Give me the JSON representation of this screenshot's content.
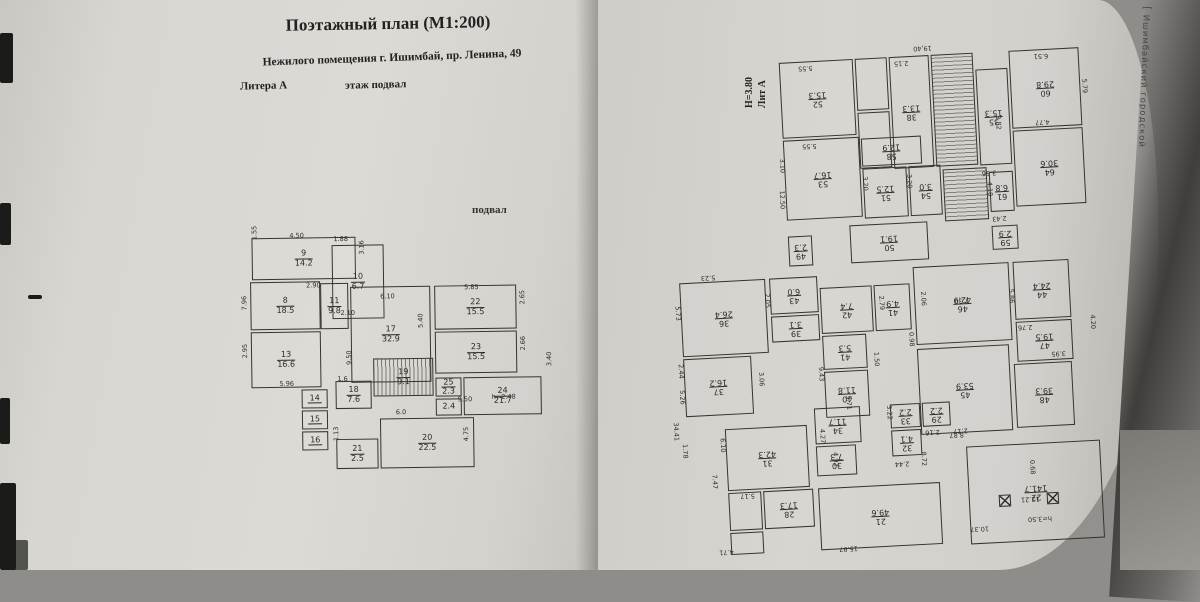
{
  "colors": {
    "paper": "#d8d6d1",
    "line": "#35342f",
    "mark": "#1b1b19"
  },
  "watermark": "ЦИАН",
  "header": {
    "title": "Поэтажный план (М1:200)",
    "subtitle": "Нежилого помещения г. Ишимбай, пр. Ленина, 49",
    "litera": "Литера А",
    "floor": "этаж  подвал"
  },
  "left_plan": {
    "caption": "подвал",
    "rooms": [
      {
        "num": "9",
        "area": "14.2",
        "box": [
          8,
          8,
          104,
          42
        ]
      },
      {
        "num": "10",
        "area": "6.7",
        "box": [
          88,
          16,
          52,
          74
        ]
      },
      {
        "num": "8",
        "area": "18.5",
        "box": [
          6,
          52,
          70,
          48
        ]
      },
      {
        "num": "11",
        "area": "9.8",
        "box": [
          76,
          54,
          28,
          46
        ]
      },
      {
        "num": "17",
        "area": "32.9",
        "box": [
          106,
          58,
          80,
          96
        ]
      },
      {
        "num": "22",
        "area": "15.5",
        "box": [
          190,
          58,
          82,
          44
        ]
      },
      {
        "num": "23",
        "area": "15.5",
        "box": [
          190,
          104,
          82,
          42
        ]
      },
      {
        "num": "13",
        "area": "16.6",
        "box": [
          6,
          102,
          70,
          56
        ]
      },
      {
        "num": "14",
        "area": "",
        "box": [
          56,
          160,
          26,
          19
        ]
      },
      {
        "num": "15",
        "area": "",
        "box": [
          56,
          181,
          26,
          19
        ]
      },
      {
        "num": "16",
        "area": "",
        "box": [
          56,
          202,
          26,
          19
        ]
      },
      {
        "num": "19",
        "area": "9.1",
        "box": [
          128,
          130,
          60,
          38
        ],
        "stairs": true
      },
      {
        "num": "18",
        "area": "7.6",
        "box": [
          90,
          152,
          36,
          28
        ]
      },
      {
        "num": "25",
        "area": "2.3",
        "box": [
          190,
          150,
          26,
          19
        ]
      },
      {
        "num": "",
        "area": "2.4",
        "box": [
          190,
          171,
          26,
          17
        ]
      },
      {
        "num": "24",
        "area": "21.7",
        "box": [
          218,
          150,
          78,
          38
        ]
      },
      {
        "num": "20",
        "area": "22.5",
        "box": [
          134,
          190,
          94,
          50
        ]
      },
      {
        "num": "21",
        "area": "2.5",
        "box": [
          90,
          210,
          42,
          30
        ]
      }
    ],
    "dims": [
      {
        "t": "1.55",
        "x": 7,
        "y": 10,
        "v": 1
      },
      {
        "t": "4.50",
        "x": 46,
        "y": 2
      },
      {
        "t": "1.88",
        "x": 90,
        "y": 6
      },
      {
        "t": "3.16",
        "x": 114,
        "y": 26,
        "v": 1
      },
      {
        "t": "2.10",
        "x": 96,
        "y": 80
      },
      {
        "t": "2.90",
        "x": 62,
        "y": 52
      },
      {
        "t": "7.96",
        "x": -4,
        "y": 80,
        "v": 1
      },
      {
        "t": "6.10",
        "x": 136,
        "y": 64
      },
      {
        "t": "5.40",
        "x": 172,
        "y": 100,
        "v": 1
      },
      {
        "t": "5.85",
        "x": 220,
        "y": 56
      },
      {
        "t": "2.65",
        "x": 274,
        "y": 78,
        "v": 1
      },
      {
        "t": "2.66",
        "x": 274,
        "y": 124,
        "v": 1
      },
      {
        "t": "2.95",
        "x": -4,
        "y": 128,
        "v": 1
      },
      {
        "t": "5.96",
        "x": 34,
        "y": 150
      },
      {
        "t": "9.50",
        "x": 100,
        "y": 136,
        "v": 1
      },
      {
        "t": "1.6",
        "x": 92,
        "y": 146
      },
      {
        "t": "6.0",
        "x": 150,
        "y": 180
      },
      {
        "t": "9.50",
        "x": 212,
        "y": 168
      },
      {
        "t": "h=2.48",
        "x": 246,
        "y": 166
      },
      {
        "t": "3.40",
        "x": 300,
        "y": 140,
        "v": 1
      },
      {
        "t": "4.75",
        "x": 216,
        "y": 214,
        "v": 1
      },
      {
        "t": "1.13",
        "x": 86,
        "y": 212,
        "v": 1
      }
    ],
    "columns": []
  },
  "right_plan": {
    "lit": "Лит А",
    "height_note": "Н=3.80",
    "stamp": "Ишимбайский городской",
    "rooms": [
      {
        "num": "52",
        "area": "15.3",
        "box": [
          133,
          25,
          74,
          76
        ]
      },
      {
        "num": "53",
        "area": "16.7",
        "box": [
          133,
          103,
          76,
          80
        ]
      },
      {
        "num": "",
        "area": "",
        "box": [
          209,
          25,
          32,
          52
        ]
      },
      {
        "num": "",
        "area": "",
        "box": [
          209,
          79,
          32,
          56
        ]
      },
      {
        "num": "38",
        "area": "13.3",
        "box": [
          243,
          25,
          40,
          112
        ]
      },
      {
        "num": "",
        "area": "",
        "box": [
          285,
          25,
          42,
          112
        ],
        "stairs": true
      },
      {
        "num": "35",
        "area": "15.3",
        "box": [
          329,
          42,
          32,
          96
        ]
      },
      {
        "num": "60",
        "area": "29.8",
        "box": [
          363,
          25,
          70,
          78
        ]
      },
      {
        "num": "58",
        "area": "12.9",
        "box": [
          211,
          105,
          60,
          28
        ]
      },
      {
        "num": "51",
        "area": "12.5",
        "box": [
          211,
          135,
          44,
          50
        ]
      },
      {
        "num": "54",
        "area": "3.0",
        "box": [
          257,
          135,
          32,
          50
        ]
      },
      {
        "num": "",
        "area": "",
        "box": [
          291,
          140,
          44,
          52
        ],
        "stairs": true
      },
      {
        "num": "64",
        "area": "30.6",
        "box": [
          363,
          105,
          70,
          76
        ]
      },
      {
        "num": "61",
        "area": "6.8",
        "box": [
          337,
          145,
          24,
          40
        ]
      },
      {
        "num": "49",
        "area": "2.3",
        "box": [
          133,
          199,
          24,
          30
        ]
      },
      {
        "num": "50",
        "area": "19.1",
        "box": [
          195,
          191,
          78,
          38
        ]
      },
      {
        "num": "59",
        "area": "2.9",
        "box": [
          337,
          199,
          26,
          24
        ]
      },
      {
        "num": "36",
        "area": "26.4",
        "box": [
          22,
          240,
          86,
          74
        ]
      },
      {
        "num": "43",
        "area": "6.0",
        "box": [
          112,
          240,
          48,
          36
        ]
      },
      {
        "num": "39",
        "area": "3.1",
        "box": [
          112,
          278,
          48,
          26
        ]
      },
      {
        "num": "42",
        "area": "7.4",
        "box": [
          162,
          252,
          52,
          46
        ]
      },
      {
        "num": "41",
        "area": "4.9",
        "box": [
          216,
          252,
          36,
          46
        ]
      },
      {
        "num": "46",
        "area": "42.9",
        "box": [
          256,
          236,
          96,
          78
        ]
      },
      {
        "num": "44",
        "area": "24.4",
        "box": [
          356,
          236,
          56,
          58
        ]
      },
      {
        "num": "47",
        "area": "19.5",
        "box": [
          356,
          296,
          56,
          40
        ]
      },
      {
        "num": "45",
        "area": "53.9",
        "box": [
          256,
          318,
          92,
          86
        ]
      },
      {
        "num": "48",
        "area": "39.3",
        "box": [
          352,
          338,
          58,
          64
        ]
      },
      {
        "num": "37",
        "area": "16.2",
        "box": [
          22,
          316,
          68,
          58
        ]
      },
      {
        "num": "41",
        "area": "5.3",
        "box": [
          162,
          300,
          44,
          34
        ]
      },
      {
        "num": "40",
        "area": "11.8",
        "box": [
          162,
          336,
          44,
          46
        ]
      },
      {
        "num": "31",
        "area": "42.3",
        "box": [
          60,
          388,
          82,
          62
        ]
      },
      {
        "num": "34",
        "area": "11.7",
        "box": [
          150,
          372,
          46,
          36
        ]
      },
      {
        "num": "30",
        "area": "7.3",
        "box": [
          150,
          410,
          40,
          30
        ]
      },
      {
        "num": "33",
        "area": "2.2",
        "box": [
          226,
          372,
          30,
          24
        ]
      },
      {
        "num": "32",
        "area": "4.1",
        "box": [
          226,
          398,
          30,
          26
        ]
      },
      {
        "num": "29",
        "area": "2.2",
        "box": [
          258,
          372,
          28,
          24
        ]
      },
      {
        "num": "28",
        "area": "17.3",
        "box": [
          95,
          452,
          50,
          38
        ]
      },
      {
        "num": "21",
        "area": "49.6",
        "box": [
          150,
          452,
          122,
          62
        ]
      },
      {
        "num": "22",
        "area": "141.7",
        "box": [
          300,
          418,
          134,
          98
        ]
      },
      {
        "num": "",
        "area": "",
        "box": [
          60,
          452,
          33,
          38
        ]
      },
      {
        "num": "",
        "area": "",
        "box": [
          60,
          492,
          33,
          22
        ]
      }
    ],
    "dims": [
      {
        "t": "19,40",
        "x": 268,
        "y": 14
      },
      {
        "t": "6.51",
        "x": 388,
        "y": 28
      },
      {
        "t": "5.79",
        "x": 430,
        "y": 60,
        "v": 1
      },
      {
        "t": "4.77",
        "x": 386,
        "y": 94
      },
      {
        "t": "3.82",
        "x": 342,
        "y": 92,
        "v": 1
      },
      {
        "t": "2.15",
        "x": 248,
        "y": 28
      },
      {
        "t": "5.55",
        "x": 152,
        "y": 28
      },
      {
        "t": "5.55",
        "x": 152,
        "y": 106
      },
      {
        "t": "3.10",
        "x": 124,
        "y": 124,
        "v": 1
      },
      {
        "t": "3.56",
        "x": 330,
        "y": 142
      },
      {
        "t": "12.50",
        "x": 120,
        "y": 158,
        "v": 1
      },
      {
        "t": "3.20",
        "x": 206,
        "y": 146,
        "v": 1
      },
      {
        "t": "3.20",
        "x": 250,
        "y": 146,
        "v": 1
      },
      {
        "t": "2.43",
        "x": 338,
        "y": 188
      },
      {
        "t": "4.18",
        "x": 330,
        "y": 158,
        "v": 1
      },
      {
        "t": "5.23",
        "x": 44,
        "y": 232
      },
      {
        "t": "5.73",
        "x": 12,
        "y": 266,
        "v": 1
      },
      {
        "t": "2.05",
        "x": 102,
        "y": 258,
        "v": 1
      },
      {
        "t": "2.44",
        "x": 12,
        "y": 324,
        "v": 1
      },
      {
        "t": "5.26",
        "x": 12,
        "y": 350,
        "v": 1
      },
      {
        "t": "3.06",
        "x": 92,
        "y": 336,
        "v": 1
      },
      {
        "t": "1.78",
        "x": 12,
        "y": 404,
        "v": 1
      },
      {
        "t": "9.43",
        "x": 152,
        "y": 334,
        "v": 1
      },
      {
        "t": "4.27",
        "x": 150,
        "y": 396,
        "v": 1
      },
      {
        "t": "1.50",
        "x": 208,
        "y": 322,
        "v": 1
      },
      {
        "t": "5.71",
        "x": 178,
        "y": 364,
        "v": 1
      },
      {
        "t": "2.79",
        "x": 216,
        "y": 266,
        "v": 1
      },
      {
        "t": "2.06",
        "x": 258,
        "y": 264,
        "v": 1
      },
      {
        "t": "0.98",
        "x": 244,
        "y": 304,
        "v": 1
      },
      {
        "t": "7.30",
        "x": 296,
        "y": 268
      },
      {
        "t": "8.87",
        "x": 284,
        "y": 402
      },
      {
        "t": "5.86",
        "x": 346,
        "y": 266,
        "v": 1
      },
      {
        "t": "4.20",
        "x": 426,
        "y": 296,
        "v": 1
      },
      {
        "t": "2.76",
        "x": 358,
        "y": 298
      },
      {
        "t": "3.95",
        "x": 390,
        "y": 326
      },
      {
        "t": "12.21",
        "x": 352,
        "y": 470
      },
      {
        "t": "0.68",
        "x": 358,
        "y": 438,
        "v": 1
      },
      {
        "t": "h=3.50",
        "x": 358,
        "y": 490
      },
      {
        "t": "10.37",
        "x": 300,
        "y": 497
      },
      {
        "t": "15.97",
        "x": 168,
        "y": 510
      },
      {
        "t": "4.71",
        "x": 48,
        "y": 507
      },
      {
        "t": "34.41",
        "x": 2,
        "y": 384,
        "v": 1
      },
      {
        "t": "6.10",
        "x": 50,
        "y": 400,
        "v": 1
      },
      {
        "t": "7.47",
        "x": 40,
        "y": 436,
        "v": 1
      },
      {
        "t": "5.17",
        "x": 72,
        "y": 452
      },
      {
        "t": "4.92",
        "x": 162,
        "y": 420,
        "v": 1
      },
      {
        "t": "3.22",
        "x": 218,
        "y": 376,
        "v": 1
      },
      {
        "t": "8.72",
        "x": 250,
        "y": 424,
        "v": 1
      },
      {
        "t": "2.44",
        "x": 228,
        "y": 428
      },
      {
        "t": "2.16",
        "x": 260,
        "y": 398
      },
      {
        "t": "2.17",
        "x": 288,
        "y": 398
      }
    ],
    "columns": [
      [
        330,
        468
      ],
      [
        378,
        468
      ]
    ]
  }
}
